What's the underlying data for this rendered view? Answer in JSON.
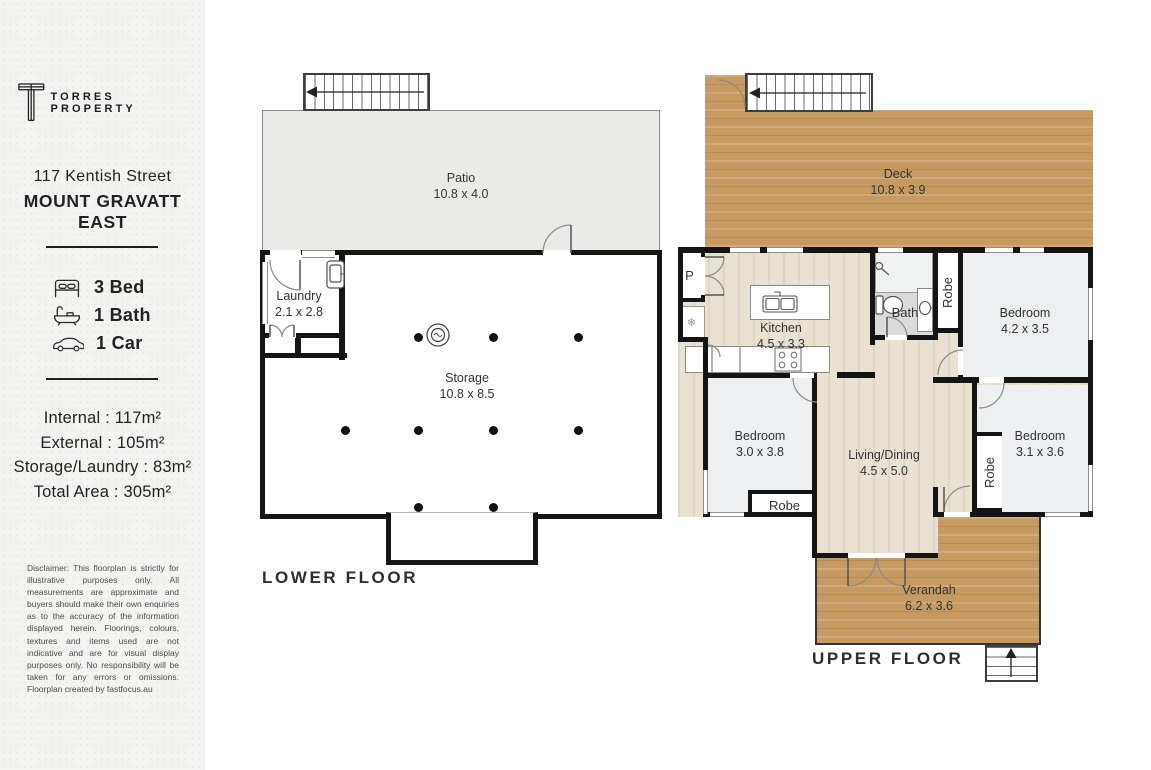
{
  "sidebar": {
    "brand": "TORRES PROPERTY",
    "address": [
      "117 Kentish Street",
      "MOUNT GRAVATT",
      "EAST"
    ],
    "features": [
      {
        "icon": "bed-icon",
        "label": "3 Bed"
      },
      {
        "icon": "bath-icon",
        "label": "1 Bath"
      },
      {
        "icon": "car-icon",
        "label": "1 Car"
      }
    ],
    "areas": [
      "Internal : 117m²",
      "External : 105m²",
      "Storage/Laundry : 83m²",
      "Total Area : 305m²"
    ],
    "disclaimer": "Disclaimer: This floorplan is strictly for illustrative purposes only. All measurements are approximate and buyers should make their own enquiries as to the accuracy of the information displayed herein. Floorings, colours, textures and items used are not indicative and are for visual display purposes only. No responsibility will be taken for any errors or omissions. Floorplan created by fastfocus.au"
  },
  "lower": {
    "floor_label": "LOWER FLOOR",
    "patio": {
      "name": "Patio",
      "dims": "10.8 x 4.0"
    },
    "laundry": {
      "name": "Laundry",
      "dims": "2.1 x 2.8"
    },
    "storage": {
      "name": "Storage",
      "dims": "10.8 x 8.5"
    }
  },
  "upper": {
    "floor_label": "UPPER FLOOR",
    "deck": {
      "name": "Deck",
      "dims": "10.8 x 3.9"
    },
    "kitchen": {
      "name": "Kitchen",
      "dims": "4.5 x 3.3"
    },
    "bath": {
      "name": "Bath"
    },
    "bedroom1": {
      "name": "Bedroom",
      "dims": "4.2 x 3.5"
    },
    "bedroom2": {
      "name": "Bedroom",
      "dims": "3.0 x 3.8"
    },
    "bedroom3": {
      "name": "Bedroom",
      "dims": "3.1 x 3.6"
    },
    "living": {
      "name": "Living/Dining",
      "dims": "4.5 x 5.0"
    },
    "verandah": {
      "name": "Verandah",
      "dims": "6.2 x 3.6"
    },
    "robe_label": "Robe",
    "pantry_label": "P"
  },
  "colors": {
    "wall": "#141414",
    "deck_wood": "#c79a62",
    "interior_wood": "#e9e1d2",
    "patio": "#eaeae8",
    "bedroom_floor": "#edeff0",
    "bath_floor": "#d9dbdc",
    "sidebar_bg": "#f3f3f1"
  }
}
